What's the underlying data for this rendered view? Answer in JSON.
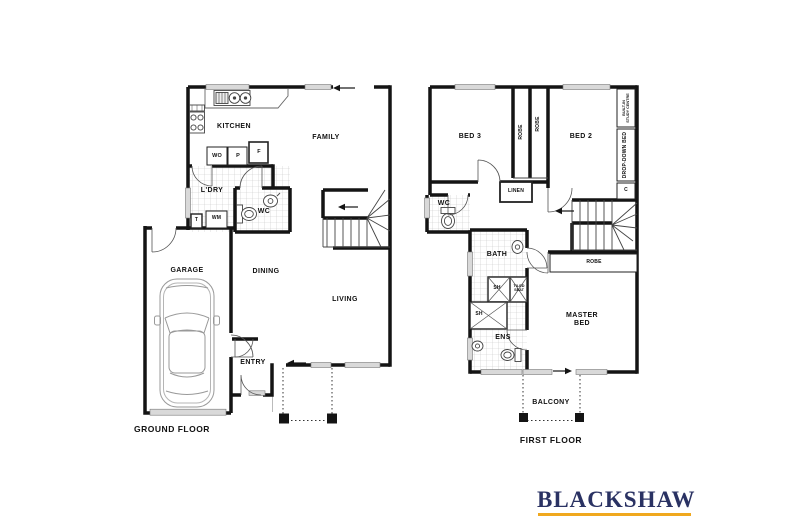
{
  "meta": {
    "background": "#ffffff",
    "wall_color": "#141414",
    "window_fill": "#d9d9d9"
  },
  "ground_floor": {
    "title": "GROUND FLOOR",
    "labels": [
      {
        "id": "kitchen",
        "text": "KITCHEN",
        "x": 234,
        "y": 127,
        "size": "m"
      },
      {
        "id": "family",
        "text": "FAMILY",
        "x": 326,
        "y": 138,
        "size": "m"
      },
      {
        "id": "wall-oven",
        "text": "WO",
        "x": 217,
        "y": 156,
        "size": "s"
      },
      {
        "id": "pantry",
        "text": "P",
        "x": 238,
        "y": 156,
        "size": "s"
      },
      {
        "id": "fridge",
        "text": "F",
        "x": 259,
        "y": 152,
        "size": "s"
      },
      {
        "id": "laundry",
        "text": "L'DRY",
        "x": 212,
        "y": 191,
        "size": "m"
      },
      {
        "id": "wc-ground",
        "text": "WC",
        "x": 264,
        "y": 212,
        "size": "m"
      },
      {
        "id": "tub",
        "text": "T",
        "x": 196.5,
        "y": 221,
        "size": "xs"
      },
      {
        "id": "washing-machine",
        "text": "WM",
        "x": 216.5,
        "y": 219,
        "size": "xs"
      },
      {
        "id": "garage",
        "text": "GARAGE",
        "x": 187,
        "y": 271,
        "size": "m"
      },
      {
        "id": "dining",
        "text": "DINING",
        "x": 266,
        "y": 272,
        "size": "m"
      },
      {
        "id": "living",
        "text": "LIVING",
        "x": 345,
        "y": 300,
        "size": "m"
      },
      {
        "id": "entry",
        "text": "ENTRY",
        "x": 253,
        "y": 363,
        "size": "m"
      }
    ]
  },
  "first_floor": {
    "title": "FIRST FLOOR",
    "labels": [
      {
        "id": "bed-3",
        "text": "BED 3",
        "x": 470,
        "y": 137,
        "size": "m"
      },
      {
        "id": "bed-2",
        "text": "BED 2",
        "x": 581,
        "y": 137,
        "size": "m"
      },
      {
        "id": "robe-bed3",
        "text": "ROBE",
        "x": 521.5,
        "y": 132,
        "size": "xs",
        "rot": 1
      },
      {
        "id": "robe-bed2",
        "text": "ROBE",
        "x": 539,
        "y": 124,
        "size": "xs",
        "rot": 1
      },
      {
        "id": "built-in-study",
        "text": "BUILT-IN\nSTUDY CENTRE",
        "x": 626,
        "y": 108,
        "size": "xxs",
        "rot": 1
      },
      {
        "id": "drop-down-bed",
        "text": "DROP-DOWN BED",
        "x": 626,
        "y": 155,
        "size": "xs",
        "rot": 1
      },
      {
        "id": "cupboard",
        "text": "C",
        "x": 626,
        "y": 191,
        "size": "xs"
      },
      {
        "id": "linen",
        "text": "LINEN",
        "x": 516,
        "y": 192,
        "size": "xs"
      },
      {
        "id": "wc-first",
        "text": "WC",
        "x": 444,
        "y": 204,
        "size": "m"
      },
      {
        "id": "bath",
        "text": "BATH",
        "x": 497,
        "y": 255,
        "size": "m"
      },
      {
        "id": "shower-bath",
        "text": "SH",
        "x": 497,
        "y": 289,
        "size": "xs"
      },
      {
        "id": "tiled-seat",
        "text": "TILED\nSEAT",
        "x": 519,
        "y": 288,
        "size": "xxs"
      },
      {
        "id": "shower-ens",
        "text": "SH",
        "x": 479,
        "y": 315,
        "size": "xs"
      },
      {
        "id": "ensuite",
        "text": "ENS",
        "x": 503,
        "y": 338,
        "size": "m"
      },
      {
        "id": "master-bed",
        "text": "MASTER\nBED",
        "x": 582,
        "y": 320,
        "size": "m"
      },
      {
        "id": "robe-master",
        "text": "ROBE",
        "x": 594,
        "y": 263,
        "size": "xs"
      },
      {
        "id": "balcony",
        "text": "BALCONY",
        "x": 551,
        "y": 403,
        "size": "m"
      }
    ]
  },
  "logo": {
    "text": "BLACKSHAW",
    "color": "#2a3263",
    "underline_color": "#f0a81e"
  }
}
